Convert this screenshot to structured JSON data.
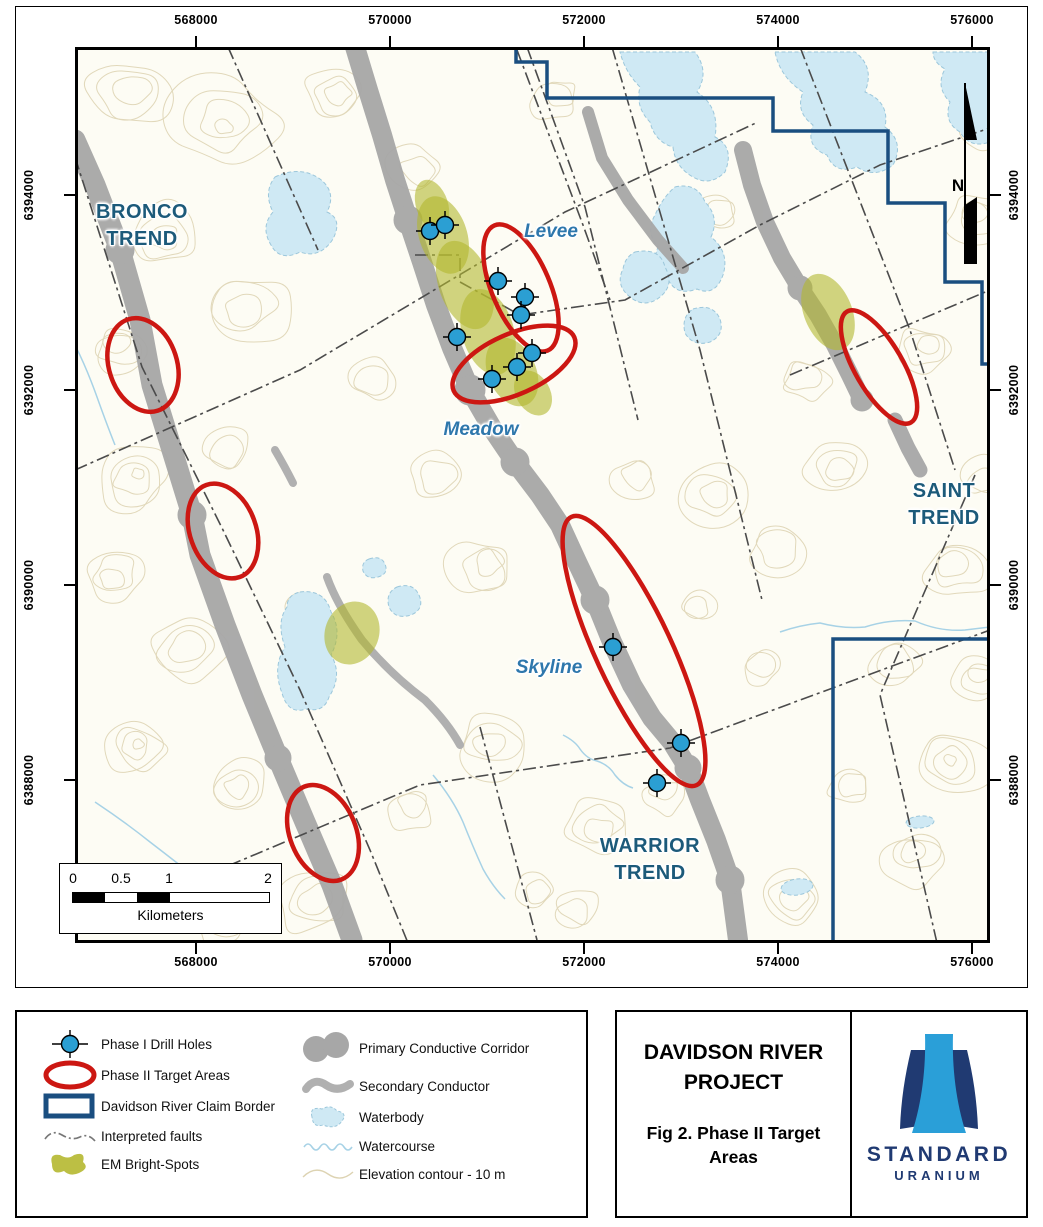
{
  "figure": {
    "axes": {
      "x": [
        "568000",
        "570000",
        "572000",
        "574000",
        "576000"
      ],
      "y": [
        "6394000",
        "6392000",
        "6390000",
        "6388000"
      ]
    },
    "trends": [
      {
        "line1": "BRONCO",
        "line2": "TREND"
      },
      {
        "line1": "SAINT",
        "line2": "TREND"
      },
      {
        "line1": "WARRIOR",
        "line2": "TREND"
      }
    ],
    "targets": [
      "Levee",
      "Meadow",
      "Skyline"
    ],
    "north": "N",
    "scalebar": {
      "ticks": [
        "0",
        "0.5",
        "1",
        "2"
      ],
      "unit": "Kilometers"
    }
  },
  "legend": {
    "left": [
      {
        "symbol": "drill-hole-icon",
        "label": "Phase I Drill Holes"
      },
      {
        "symbol": "target-ellipse-icon",
        "label": "Phase II Target Areas"
      },
      {
        "symbol": "claim-border-icon",
        "label": "Davidson River Claim Border"
      },
      {
        "symbol": "fault-line-icon",
        "label": "Interpreted faults"
      },
      {
        "symbol": "em-bright-spot-icon",
        "label": "EM Bright-Spots"
      }
    ],
    "right": [
      {
        "symbol": "primary-corridor-icon",
        "label": "Primary Conductive Corridor"
      },
      {
        "symbol": "secondary-conductor-icon",
        "label": "Secondary Conductor"
      },
      {
        "symbol": "waterbody-icon",
        "label": "Waterbody"
      },
      {
        "symbol": "watercourse-icon",
        "label": "Watercourse"
      },
      {
        "symbol": "elevation-contour-icon",
        "label": "Elevation contour - 10 m"
      }
    ]
  },
  "title_block": {
    "title": "DAVIDSON RIVER PROJECT",
    "subtitle": "Fig 2. Phase II Target Areas",
    "brand": "STANDARD",
    "brand_sub": "URANIUM"
  },
  "colors": {
    "target_red": "#cc1712",
    "claim_border_blue": "#1a4e80",
    "corridor_gray": "#a7a7a7",
    "em_olive": "#b3b82e",
    "waterbody_blue": "#cfe9f4",
    "drill_blue": "#2b9fd3",
    "target_label_blue": "#2e77ac",
    "trend_label_blue": "#1c5a7a",
    "contour_tan": "#e1d8ba",
    "logo_navy": "#203a72",
    "logo_light_blue": "#2a9fd8"
  }
}
